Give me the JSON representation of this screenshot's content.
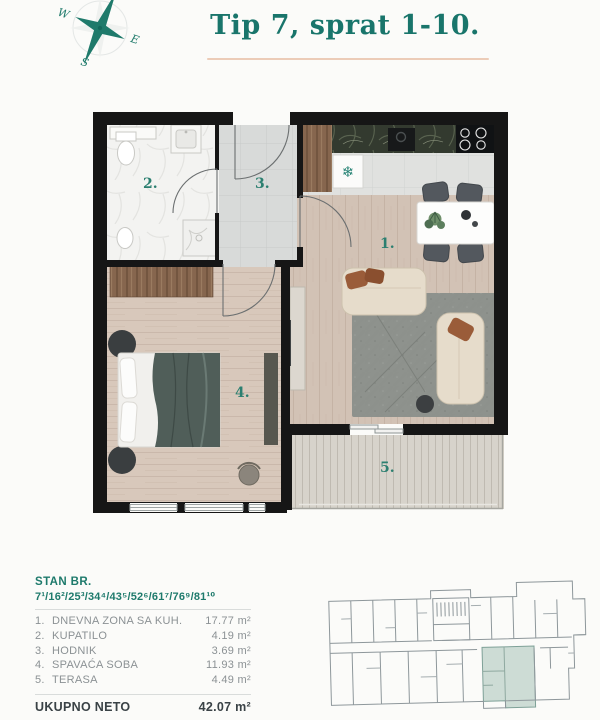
{
  "title": "Tip 7, sprat 1-10.",
  "compass": {
    "west": "W",
    "east": "E",
    "south": "S"
  },
  "plan": {
    "room_labels": [
      {
        "num": "1."
      },
      {
        "num": "2."
      },
      {
        "num": "3."
      },
      {
        "num": "4."
      },
      {
        "num": "5."
      }
    ]
  },
  "legend": {
    "stan_br_label": "STAN BR.",
    "apartment_numbers": "7¹/16²/25³/34⁴/43⁵/52⁶/61⁷/76⁹/81¹⁰",
    "rows": [
      {
        "num": "1.",
        "name": "DNEVNA ZONA SA KUH.",
        "area": "17.77 m²"
      },
      {
        "num": "2.",
        "name": "KUPATILO",
        "area": "4.19 m²"
      },
      {
        "num": "3.",
        "name": "HODNIK",
        "area": "3.69 m²"
      },
      {
        "num": "4.",
        "name": "SPAVAĆA SOBA",
        "area": "11.93 m²"
      },
      {
        "num": "5.",
        "name": "TERASA",
        "area": "4.49 m²"
      }
    ],
    "total_label": "UKUPNO NETO",
    "total_area": "42.07 m²"
  },
  "colors": {
    "accent_teal": "#1e7a6c",
    "title_underline": "#ecccb8",
    "wall_black": "#161616",
    "keyplan_highlight": "#cddcd5",
    "row_text_gray": "#8b9194"
  }
}
